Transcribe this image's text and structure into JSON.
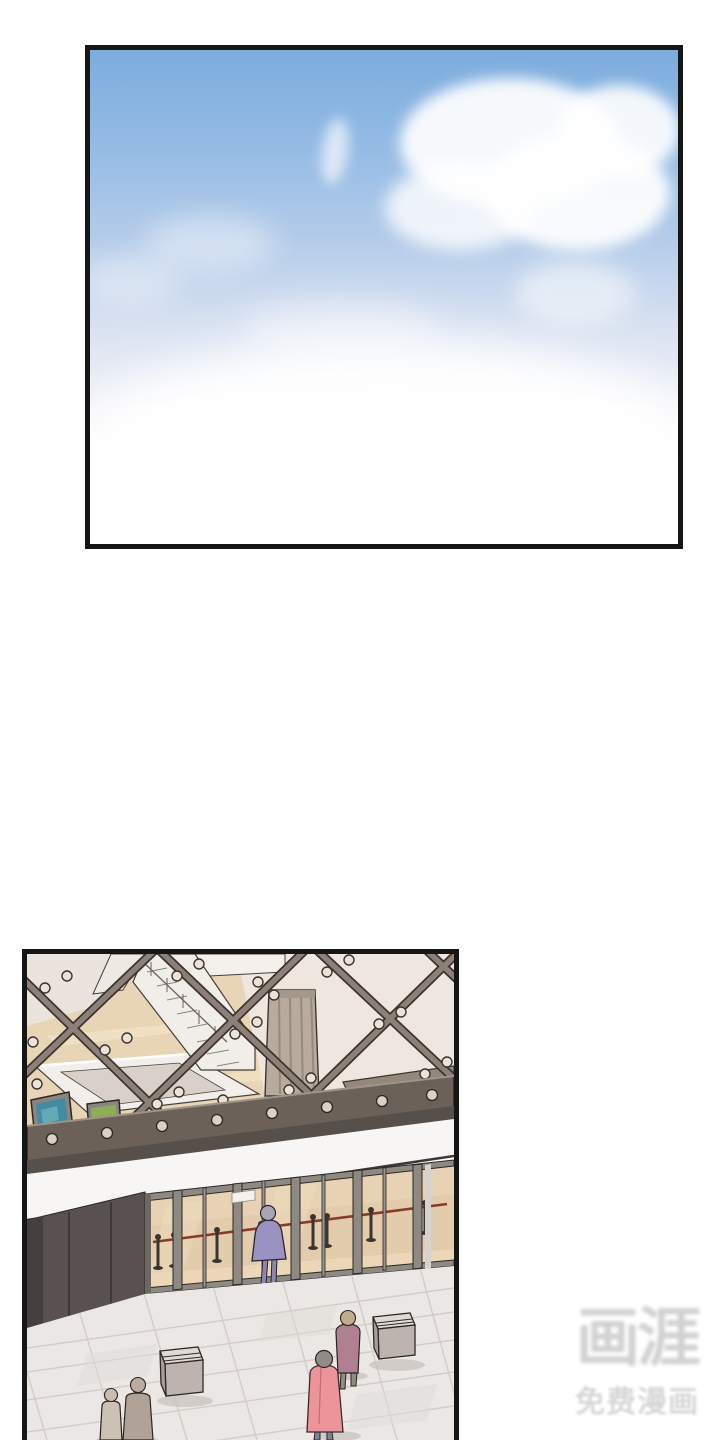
{
  "watermark": {
    "logo": "画涯",
    "subtitle": "免费漫画"
  },
  "palette": {
    "sky-top": "#7dacdd",
    "sky-mid": "#b3cbe9",
    "sky-soft": "#f1f2f8",
    "beige-floor": "#e8d5b6",
    "cream-wall": "#ebe4dc",
    "pale-wall": "#efe6e0",
    "lattice-strut": "#8d8078",
    "lattice-dark": "#3b332d",
    "beam-dark": "#6b6159",
    "fascia-white": "#f8f6f4",
    "wall-dark": "#595150",
    "door-glass": "#e3ccac",
    "door-frame": "#8f8983",
    "rope-red": "#8c3a28",
    "stanchion": "#3a3532",
    "tile-floor": "#eae7e4",
    "tile-line": "#d3ccc8",
    "figure-purple": "#9a93c1",
    "figure-pink": "#ec949a",
    "figure-mauve": "#ae8092",
    "figure-tan": "#cdc1b5",
    "figure-brown": "#b1a298",
    "painting-teal": "#418ca0",
    "painting-green": "#8fae54",
    "watermark-gray": "#d1d1d1",
    "panel-border": "#161616"
  }
}
